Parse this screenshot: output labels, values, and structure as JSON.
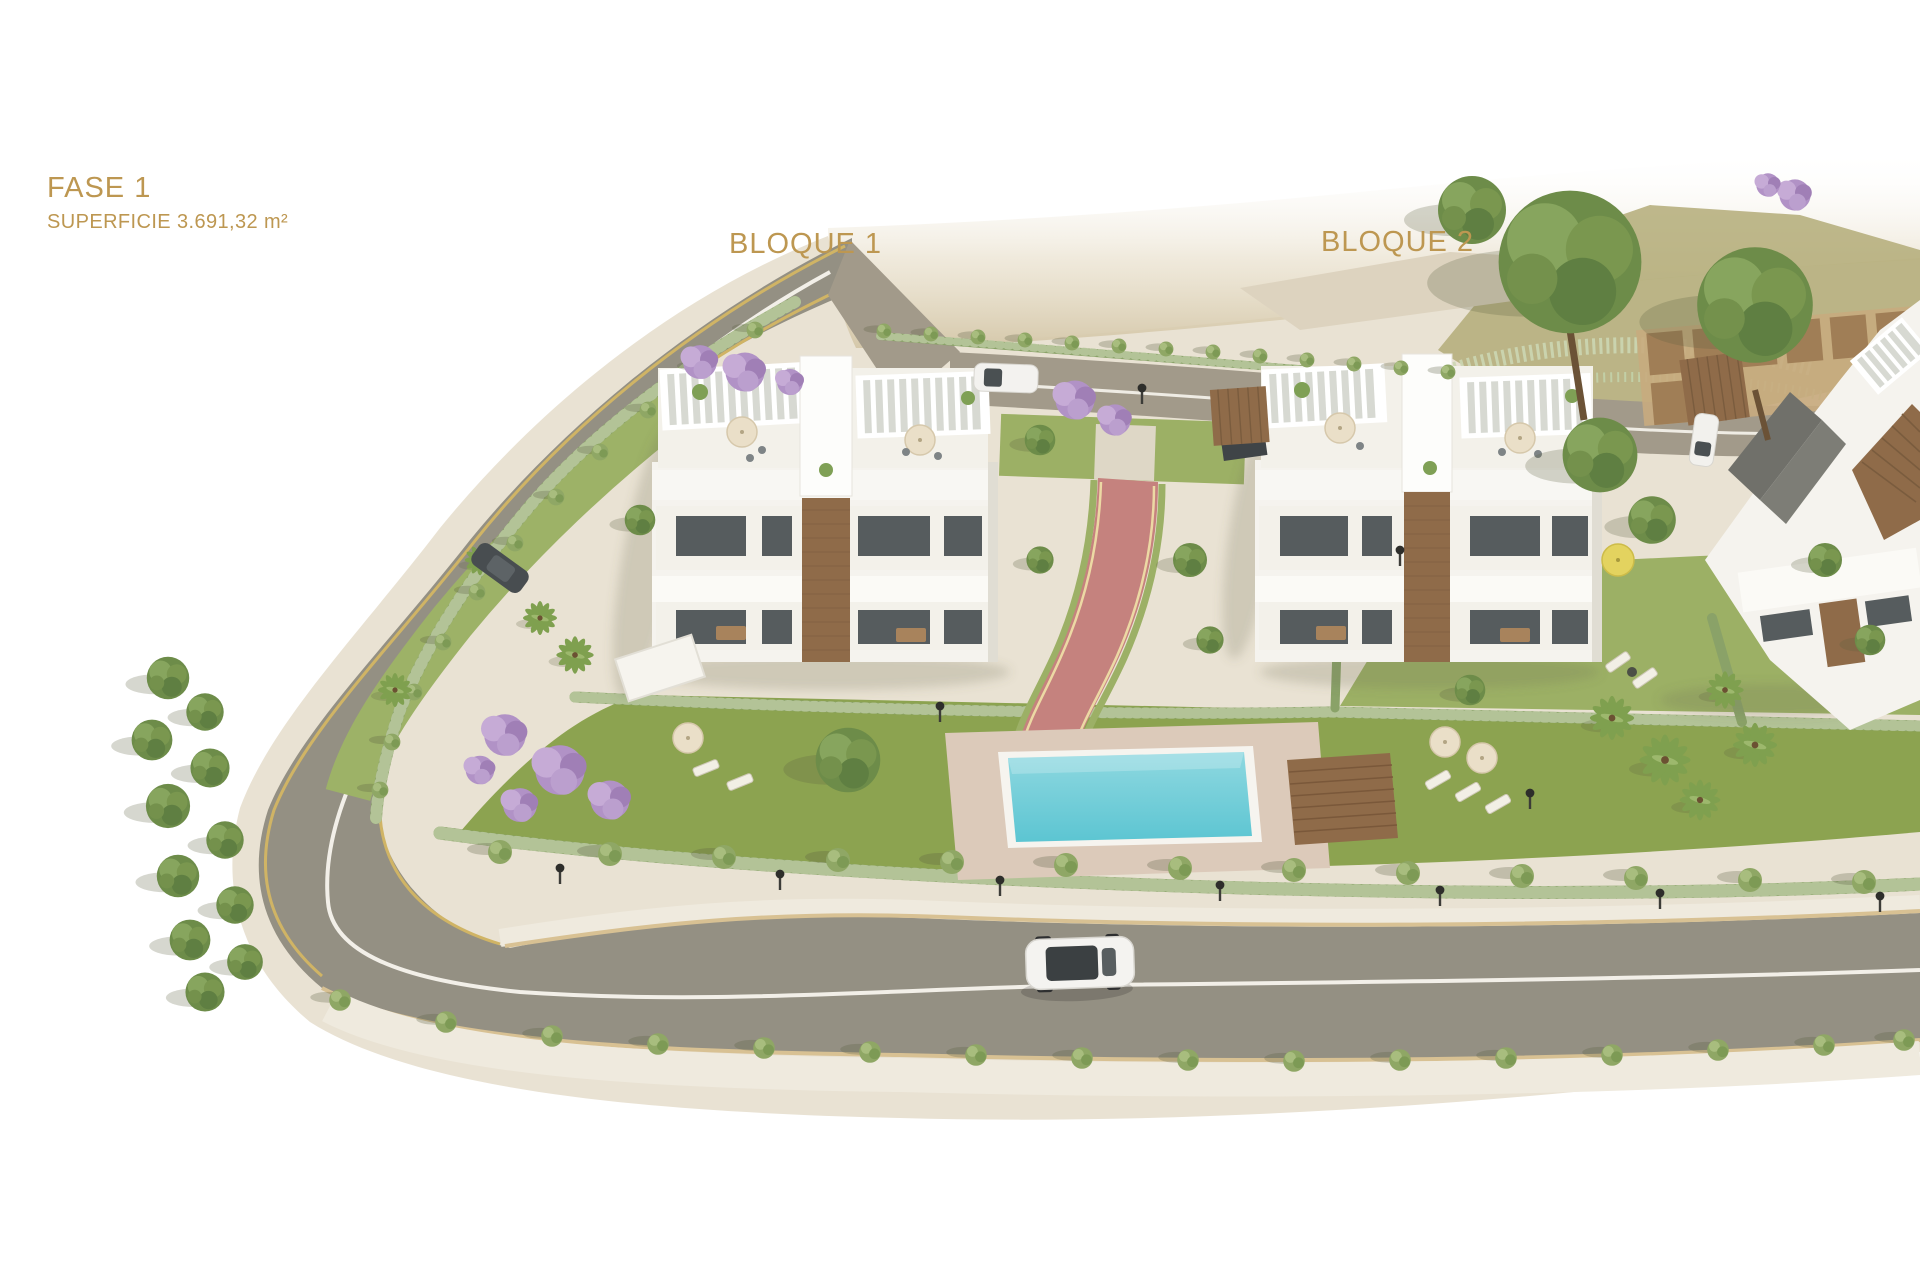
{
  "labels": {
    "phase": "FASE 1",
    "surface": "SUPERFICIE 3.691,32 m²",
    "block1": "BLOQUE 1",
    "block2": "BLOQUE 2"
  },
  "colors": {
    "label-gold": "#bd9751",
    "land-beige": "#e9e2d3",
    "sand-slope": "#d5c8aa",
    "road-asphalt": "#949083",
    "road-top": "#a29a8a",
    "sidewalk": "#efeade",
    "edge-yellow": "#d0b465",
    "lawn-green": "#8ca350",
    "hedge-green": "#8aa268",
    "tree-green": "#6d8c49",
    "jacaranda-purple": "#b192c6",
    "pool-water": "#8fd8e0",
    "pool-water-deep": "#5cc5d2",
    "pool-deck": "#dccaba",
    "wood-brown": "#8f6b49",
    "path-red": "#c5827e",
    "building-white": "#f5f3ee",
    "car-dark": "#474c4f"
  }
}
